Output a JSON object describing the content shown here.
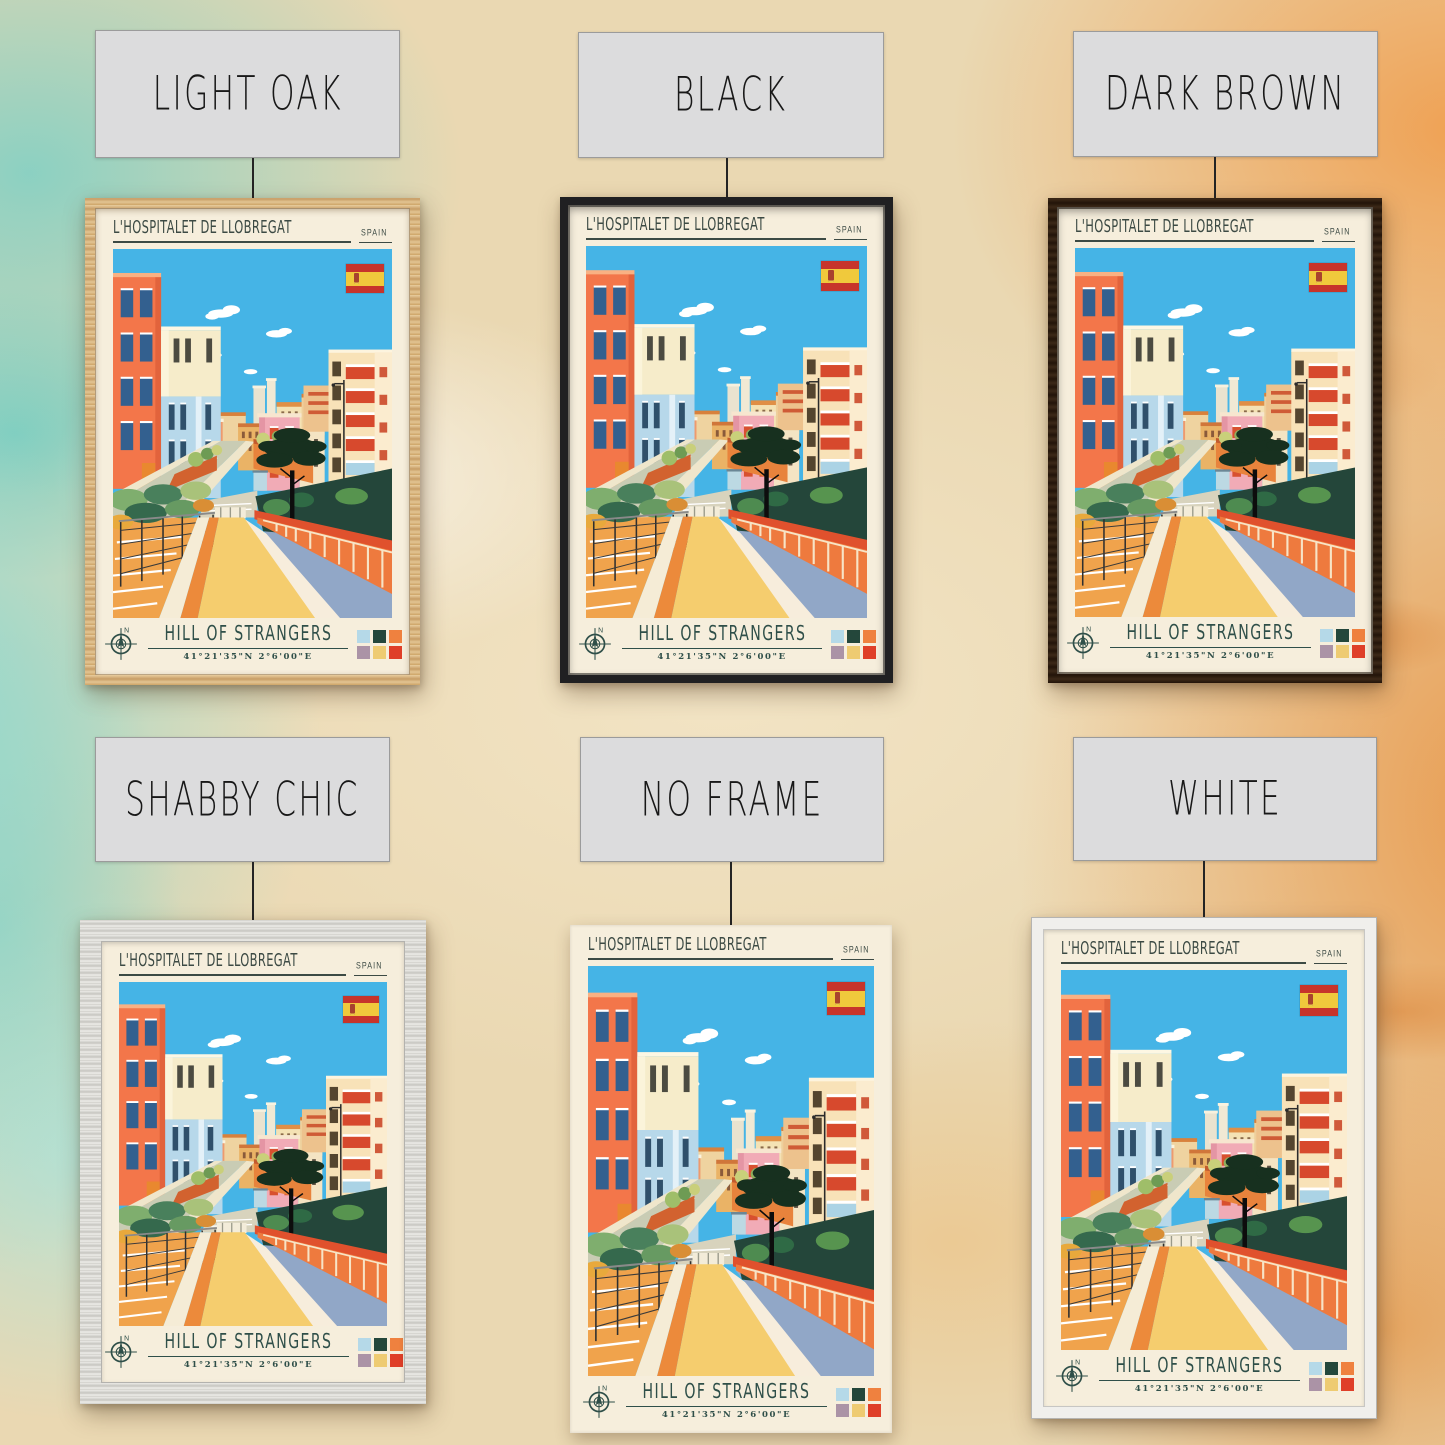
{
  "variants": [
    {
      "label": "LIGHT OAK",
      "frame": "light-oak"
    },
    {
      "label": "BLACK",
      "frame": "black"
    },
    {
      "label": "DARK BROWN",
      "frame": "dark-brown"
    },
    {
      "label": "SHABBY CHIC",
      "frame": "shabby-chic"
    },
    {
      "label": "NO FRAME",
      "frame": "no-frame"
    },
    {
      "label": "WHITE",
      "frame": "white"
    }
  ],
  "poster": {
    "title": "L'HOSPITALET DE LLOBREGAT",
    "country": "SPAIN",
    "place": "HILL OF STRANGERS",
    "coordinates": "41°21'35\"N 2°6'00\"E",
    "compass_label": "N",
    "background_color": "#f6eedc",
    "text_color": "#2f4f49",
    "palette": [
      "#b5d9e8",
      "#24473b",
      "#ef813f",
      "#ab93a6",
      "#eecb72",
      "#df3f28"
    ],
    "flag": {
      "name": "spain-flag",
      "red": "#c7342b",
      "yellow": "#f0c93c"
    }
  }
}
